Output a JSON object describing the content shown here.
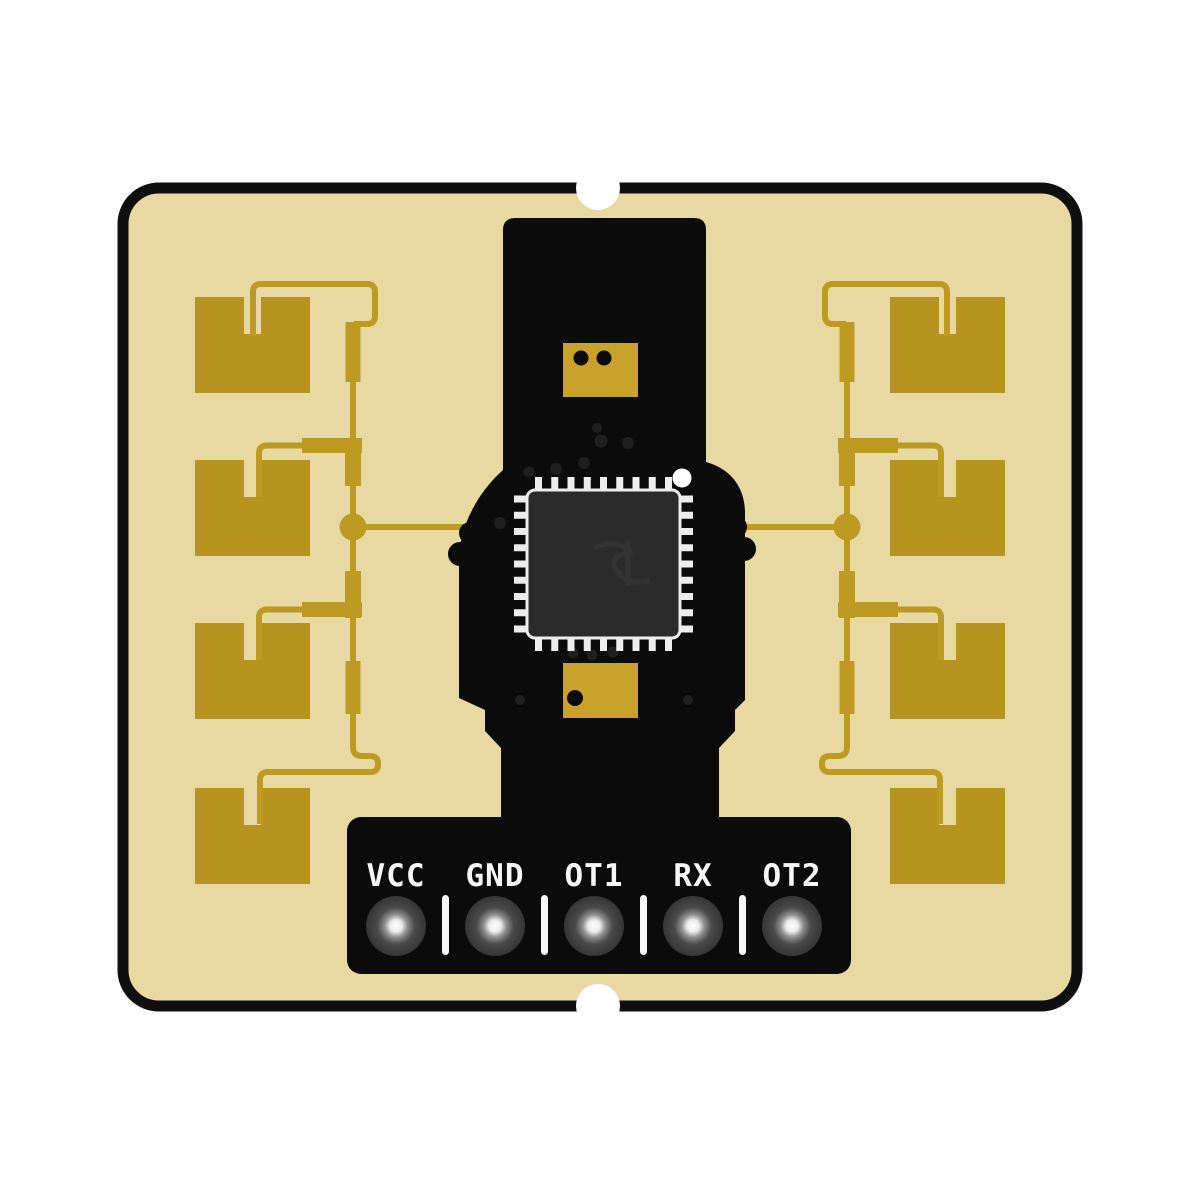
{
  "colors": {
    "background": "#ffffff",
    "board_substrate": "#e7d9a1",
    "board_outline_black": "#0f0f0f",
    "copper_patch_gold": "#b6941f",
    "copper_trace_gold": "#bd9b23",
    "component_pad_gold": "#c9a22a",
    "shield_black": "#0b0b0b",
    "chip_body_gray": "#2b2b2b",
    "chip_pin_white": "#ededed",
    "silkscreen_white": "#f7f7f7"
  },
  "header": {
    "pins": [
      {
        "label": "VCC"
      },
      {
        "label": "GND"
      },
      {
        "label": "OT1"
      },
      {
        "label": "RX"
      },
      {
        "label": "OT2"
      }
    ]
  },
  "chip": {
    "pins_per_side": 9,
    "pin1_marker": "white-dot"
  },
  "antenna": {
    "patches_left": 4,
    "patches_right": 4
  }
}
